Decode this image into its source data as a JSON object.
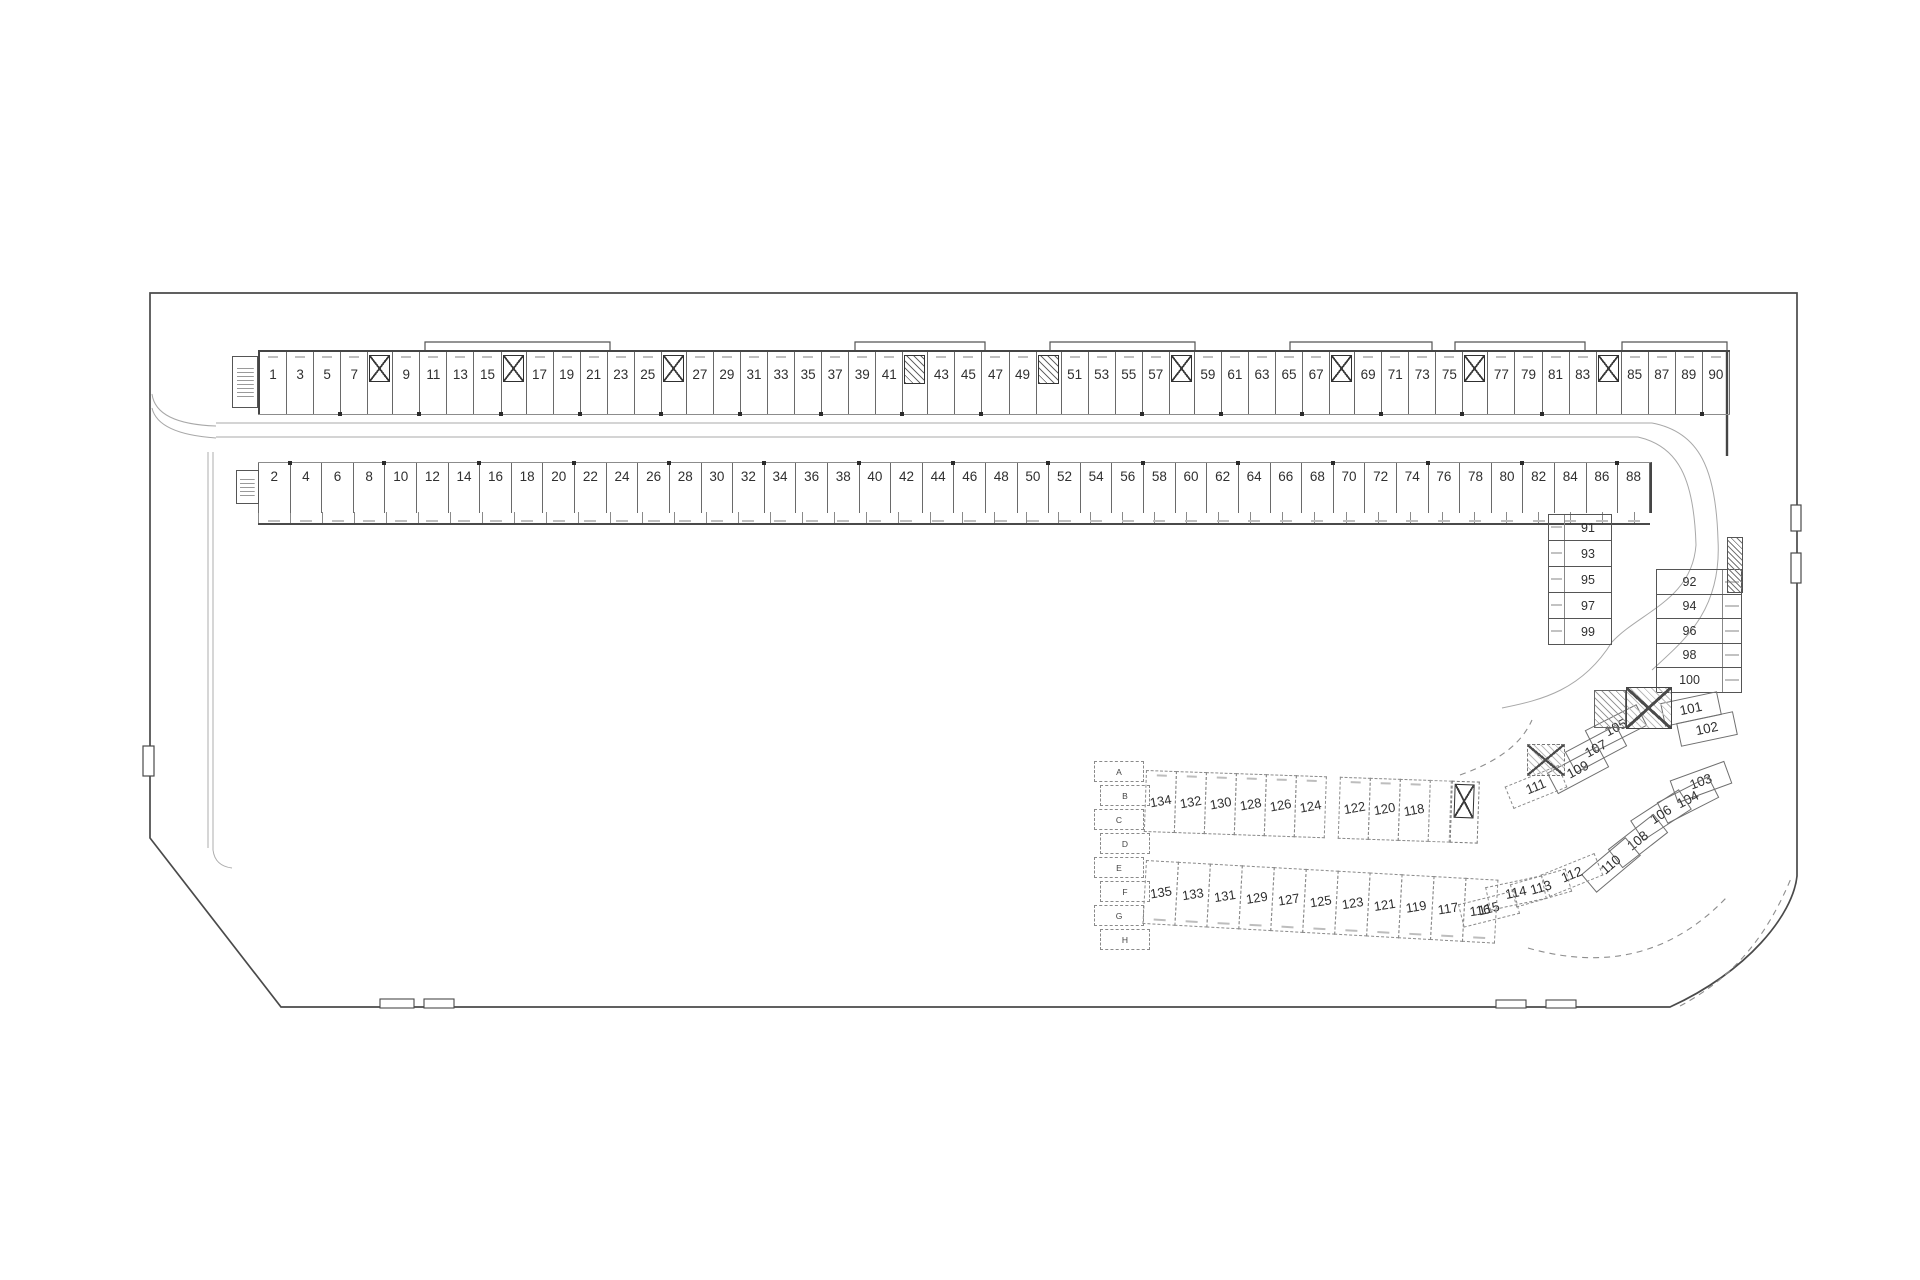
{
  "plan": {
    "top_row": {
      "cells": [
        "1",
        "3",
        "5",
        "7",
        "X",
        "9",
        "11",
        "13",
        "15",
        "X",
        "17",
        "19",
        "21",
        "23",
        "25",
        "X",
        "27",
        "29",
        "31",
        "33",
        "35",
        "37",
        "39",
        "41",
        "S",
        "43",
        "45",
        "47",
        "49",
        "S",
        "51",
        "53",
        "55",
        "57",
        "X",
        "59",
        "61",
        "63",
        "65",
        "67",
        "X",
        "69",
        "71",
        "73",
        "75",
        "X",
        "77",
        "79",
        "81",
        "83",
        "X",
        "85",
        "87",
        "89",
        "90"
      ]
    },
    "bottom_row": {
      "cells": [
        "2",
        "4",
        "6",
        "8",
        "10",
        "12",
        "14",
        "16",
        "18",
        "20",
        "22",
        "24",
        "26",
        "28",
        "30",
        "32",
        "34",
        "36",
        "38",
        "40",
        "42",
        "44",
        "46",
        "48",
        "50",
        "52",
        "54",
        "56",
        "58",
        "60",
        "62",
        "64",
        "66",
        "68",
        "70",
        "72",
        "74",
        "76",
        "78",
        "80",
        "82",
        "84",
        "86",
        "88"
      ]
    },
    "col_91_99": [
      "91",
      "93",
      "95",
      "97",
      "99"
    ],
    "col_92_100": [
      "92",
      "94",
      "96",
      "98",
      "100"
    ],
    "fan_stalls": [
      {
        "n": "101",
        "x": 1690,
        "y": 708,
        "r": -12
      },
      {
        "n": "102",
        "x": 1706,
        "y": 728,
        "r": -12
      },
      {
        "n": "103",
        "x": 1700,
        "y": 781,
        "r": -20
      },
      {
        "n": "104",
        "x": 1687,
        "y": 799,
        "r": -27
      },
      {
        "n": "105",
        "x": 1615,
        "y": 727,
        "r": -27
      },
      {
        "n": "106",
        "x": 1660,
        "y": 814,
        "r": -33
      },
      {
        "n": "107",
        "x": 1595,
        "y": 748,
        "r": -28
      },
      {
        "n": "108",
        "x": 1637,
        "y": 840,
        "r": -38
      },
      {
        "n": "109",
        "x": 1577,
        "y": 769,
        "r": -28
      },
      {
        "n": "110",
        "x": 1610,
        "y": 864,
        "r": -40
      },
      {
        "n": "111",
        "x": 1535,
        "y": 786,
        "r": -22,
        "d": 1
      },
      {
        "n": "112",
        "x": 1571,
        "y": 874,
        "r": -22,
        "d": 1
      },
      {
        "n": "113",
        "x": 1540,
        "y": 887,
        "r": -16,
        "d": 1
      },
      {
        "n": "114",
        "x": 1515,
        "y": 892,
        "r": -12,
        "d": 1
      },
      {
        "n": "115",
        "x": 1488,
        "y": 908,
        "r": -14,
        "d": 1
      }
    ],
    "dashed_row_upper": {
      "cells": [
        "134",
        "132",
        "130",
        "128",
        "126",
        "124",
        "GAP",
        "122",
        "120",
        "118",
        "BLANK",
        "X"
      ]
    },
    "dashed_row_lower": {
      "cells": [
        "135",
        "133",
        "131",
        "129",
        "127",
        "125",
        "123",
        "121",
        "119",
        "117",
        "116"
      ]
    },
    "zone_letters": [
      "A",
      "B",
      "C",
      "D",
      "E",
      "F",
      "G",
      "H"
    ],
    "colors": {
      "line": "#4a4a4a",
      "line_light": "#999999",
      "text": "#2f2f2f"
    }
  }
}
